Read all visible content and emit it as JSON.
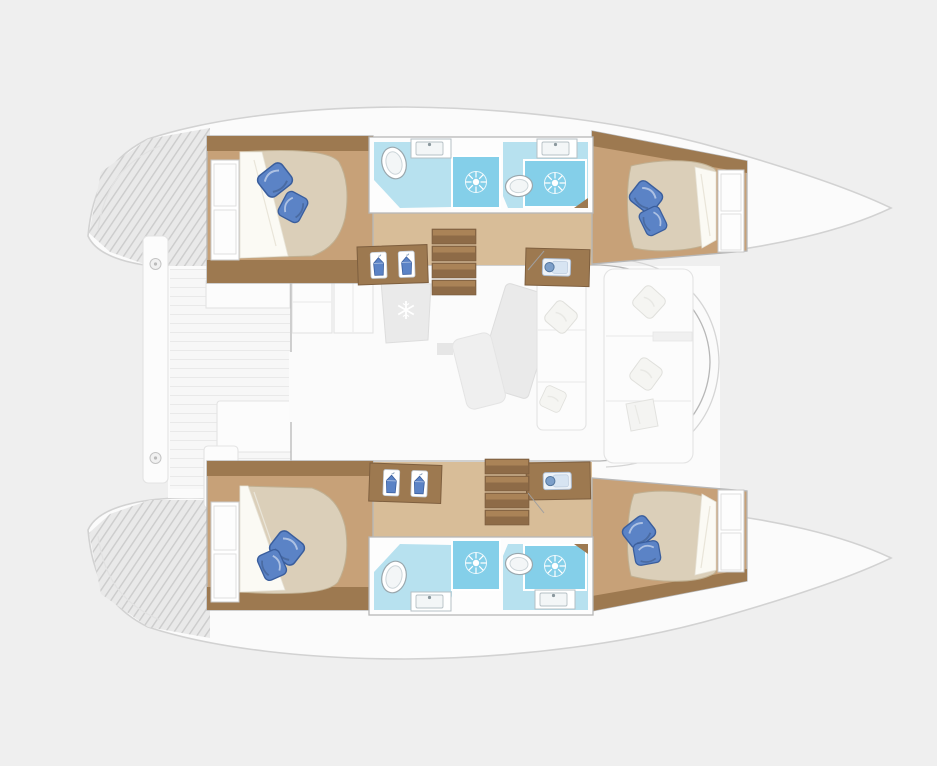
{
  "meta": {
    "title": "Catamaran yacht deck floor plan, top-down view, bow to the right",
    "view": "top-down",
    "orientation": "bow-right"
  },
  "colors": {
    "bg": "#efefef",
    "hull": "#fbfbfb",
    "hull_line": "#d2d2d2",
    "hatch_bg": "#e9e9e9",
    "hatch_line": "#cccccc",
    "wall": "#b7b7b7",
    "wood_dark": "#9d7950",
    "wood_mid": "#c7a178",
    "wood_light": "#d8bd98",
    "tread_dark": "#8e6b47",
    "tread_light": "#aa8357",
    "mattress": "#dbcfb9",
    "mattress_line": "#c0b092",
    "sheet": "#fbfaf4",
    "pillow": "#5b83c6",
    "pillow_dark": "#3a5e9d",
    "bath_floor": "#b7e1ef",
    "shower": "#84cfe9",
    "fixture": "#ffffff",
    "fixture_line": "#9aa7ad",
    "fixture_inner": "#ccd5d9",
    "furniture": "#eaeaea",
    "furniture_line": "#dddddd",
    "white_furn": "#fcfcfc",
    "white_furn_line": "#e3e3e3",
    "deck_line": "#e2e2e2",
    "icon_blue": "#7d9fc9",
    "icon_blue_dark": "#54779f",
    "door_line": "#a0a0a0",
    "plank_bg": "#f7f7f7",
    "plank_line": "#e9e9e9"
  },
  "icons": {
    "snowflake-icon": "refrigerator",
    "hanger-icon": "hanging wardrobe locker",
    "shower-drain-icon": "shower floor with sunburst drain",
    "toilet-icon": "toilet",
    "washbasin-icon": "oval washbasin",
    "vanity-sink-icon": "counter with rectangular sink and faucet",
    "berth-pillow-icon": "blue berth pillow",
    "cleat-icon": "round deck cleat"
  },
  "layout": {
    "saloon": {
      "galley_counters": 2,
      "refrigerator_count": 1,
      "dining_table_count": 1,
      "sofa": {
        "pillows": 2
      },
      "forward_lounge": {
        "seat_sections": 3,
        "pillows": 3
      }
    },
    "aft_cockpit": {
      "benches": 2,
      "lockers": 1,
      "platform_cleats": 2
    },
    "companionways": [
      {
        "hull": "port",
        "steps": 4
      },
      {
        "hull": "starboard",
        "steps": 4
      }
    ],
    "port_hull": {
      "aft_cabin": {
        "berth": "double",
        "pillows": 2,
        "shelf_cells": 2
      },
      "wardrobe_hangers": 2,
      "aft_bathroom": {
        "washbasin": 1,
        "vanity_sink": 1,
        "shower": 1
      },
      "forward_bathroom": {
        "toilet": 1,
        "vanity_sink": 1,
        "shower": 1
      },
      "sink_cabinet": 1,
      "forward_cabin": {
        "berth": "double",
        "pillows": 2,
        "shelf_cells": 2
      }
    },
    "starboard_hull": {
      "aft_cabin": {
        "berth": "double",
        "pillows": 2,
        "shelf_cells": 2
      },
      "wardrobe_hangers": 2,
      "aft_bathroom": {
        "washbasin": 1,
        "vanity_sink": 1,
        "shower": 1
      },
      "forward_bathroom": {
        "toilet": 1,
        "vanity_sink": 1,
        "shower": 1
      },
      "sink_cabinet": 1,
      "forward_cabin": {
        "berth": "double",
        "pillows": 2,
        "shelf_cells": 2
      }
    }
  }
}
